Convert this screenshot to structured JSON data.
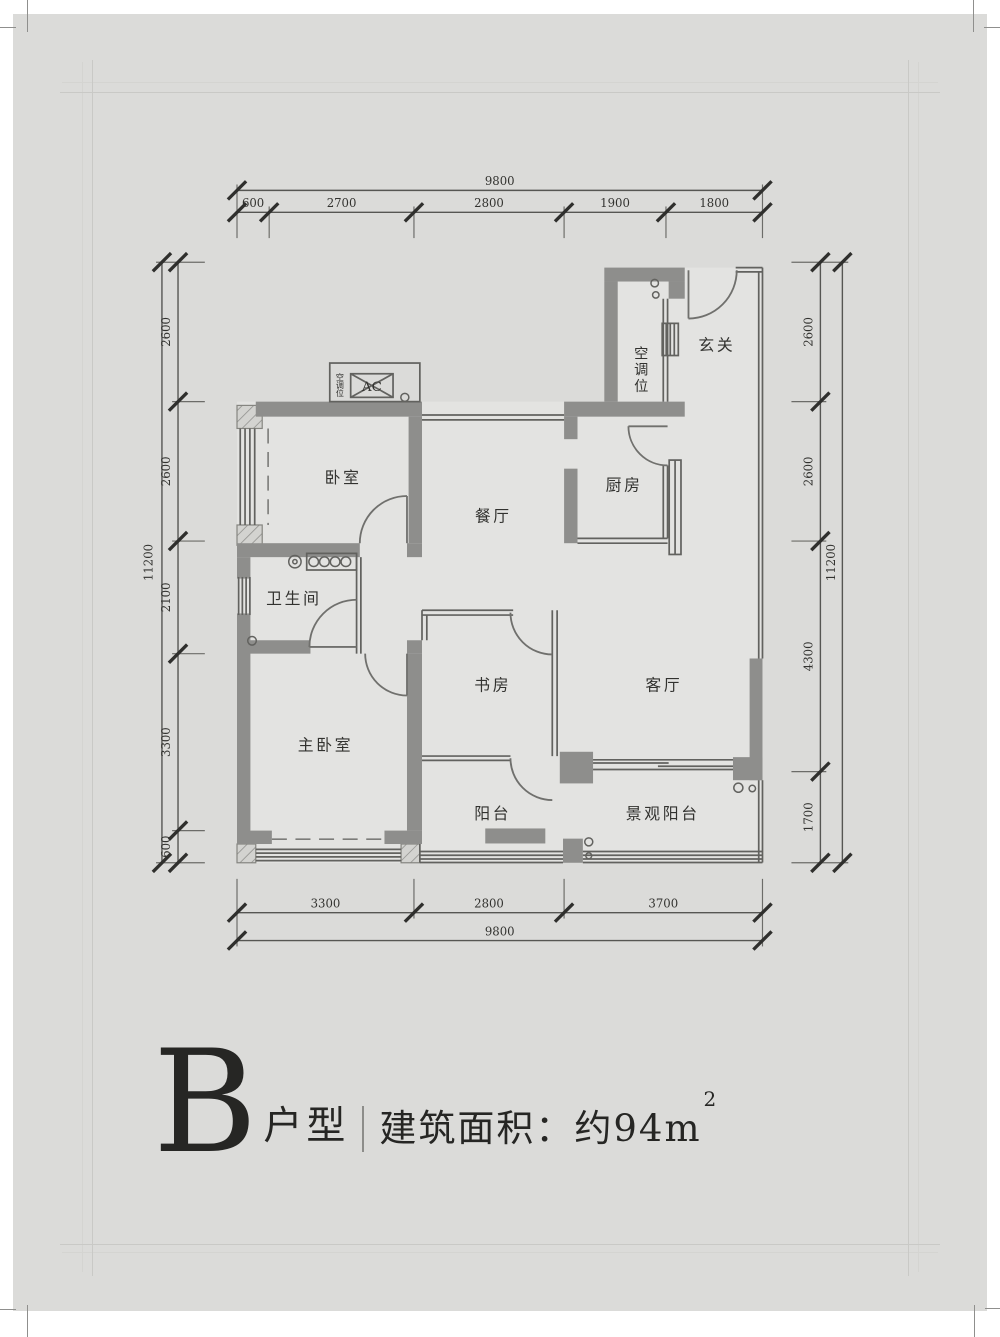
{
  "title": {
    "letter": "B",
    "suffix": "户型",
    "area": "建筑面积：约94m",
    "area_sup": "2"
  },
  "rooms": {
    "bedroom": "卧室",
    "dining": "餐厅",
    "kitchen": "厨房",
    "entry": "玄关",
    "shaft": "空调位",
    "bath": "卫生间",
    "study": "书房",
    "living": "客厅",
    "master": "主卧室",
    "balcony": "阳台",
    "view_balcony": "景观阳台",
    "ac": "AC",
    "ac_side": "空调位"
  },
  "dims": {
    "top": {
      "total": "9800",
      "seg": [
        "600",
        "2700",
        "2800",
        "1900",
        "1800"
      ]
    },
    "bottom": {
      "total": "9800",
      "seg": [
        "3300",
        "2800",
        "3700"
      ]
    },
    "left": {
      "total": "11200",
      "seg": [
        "2600",
        "2600",
        "2100",
        "3300",
        "600"
      ]
    },
    "right": {
      "total": "11200",
      "seg": [
        "2600",
        "2600",
        "4300",
        "1700"
      ]
    }
  },
  "colors": {
    "page_bg": "#dbdbd9",
    "floor": "#e3e3e1",
    "wall": "#8e8e8c",
    "line": "#565653",
    "text": "#262624"
  }
}
